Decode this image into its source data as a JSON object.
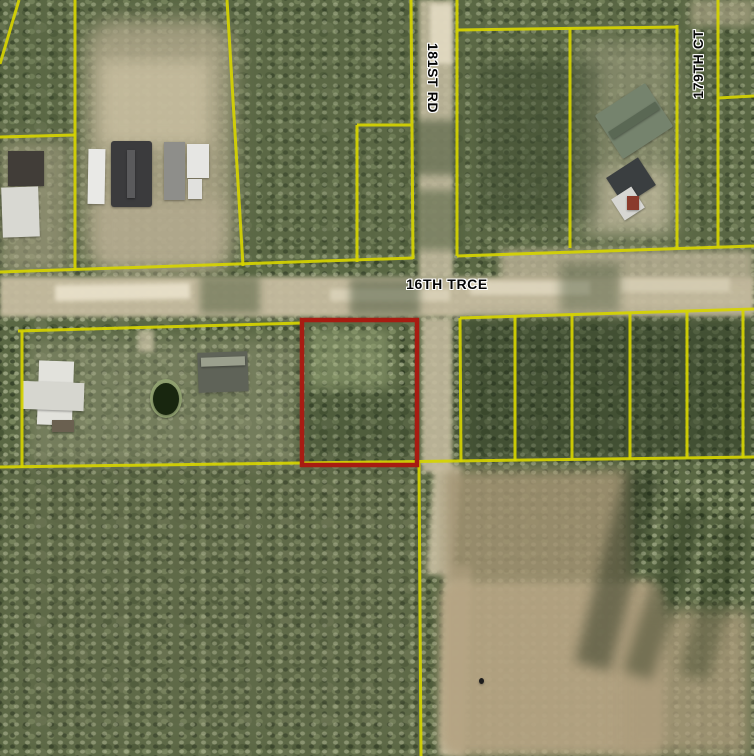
{
  "map": {
    "width": 754,
    "height": 756,
    "description": "Aerial parcel map with subject parcel outlined in red",
    "colors": {
      "parcel_line": "#d6d400",
      "highlight": "#a81c12",
      "forest": "#5a6844",
      "road": "#c6bca0",
      "field": "#b5a483",
      "label_text": "#050505",
      "label_halo": "#ffffff"
    },
    "labels": [
      {
        "name": "street-label-181st-rd",
        "text": "181ST RD",
        "x": 433,
        "y": 78,
        "orientation": "vertical-down"
      },
      {
        "name": "street-label-179th-ct",
        "text": "179TH CT",
        "x": 698,
        "y": 64,
        "orientation": "vertical-up"
      },
      {
        "name": "street-label-16th-trce",
        "text": "16TH TRCE",
        "x": 447,
        "y": 284,
        "orientation": "horizontal"
      }
    ],
    "highlight_parcel": {
      "name": "highlighted-parcel-outline",
      "x": 302,
      "y": 320,
      "w": 115,
      "h": 145,
      "stroke_width": 4.5
    },
    "parcel_lines": [
      {
        "name": "boundary-topleft-diagonal",
        "x1": 19,
        "y1": 0,
        "x2": 0,
        "y2": 64
      },
      {
        "name": "boundary-vertical-75",
        "x1": 75,
        "y1": 0,
        "x2": 75,
        "y2": 270
      },
      {
        "name": "boundary-horizontal-left",
        "x1": 0,
        "y1": 137,
        "x2": 75,
        "y2": 135
      },
      {
        "name": "boundary-vertical-235",
        "x1": 227,
        "y1": 0,
        "x2": 243,
        "y2": 266
      },
      {
        "name": "road-north-boundary-west",
        "x1": 0,
        "y1": 272,
        "x2": 413,
        "y2": 258
      },
      {
        "name": "boundary-vertical-357",
        "x1": 357,
        "y1": 262,
        "x2": 357,
        "y2": 125
      },
      {
        "name": "boundary-horizontal-357-411",
        "x1": 357,
        "y1": 125,
        "x2": 411,
        "y2": 125
      },
      {
        "name": "boundary-vertical-412-west-of-181st",
        "x1": 411,
        "y1": 0,
        "x2": 413,
        "y2": 259
      },
      {
        "name": "boundary-vertical-457-east-of-181st",
        "x1": 457,
        "y1": 0,
        "x2": 457,
        "y2": 256
      },
      {
        "name": "boundary-horizontal-457-677",
        "x1": 457,
        "y1": 30,
        "x2": 677,
        "y2": 27
      },
      {
        "name": "boundary-vertical-570",
        "x1": 570,
        "y1": 28,
        "x2": 570,
        "y2": 248
      },
      {
        "name": "boundary-vertical-677",
        "x1": 677,
        "y1": 25,
        "x2": 677,
        "y2": 249
      },
      {
        "name": "boundary-vertical-718",
        "x1": 718,
        "y1": 0,
        "x2": 718,
        "y2": 248
      },
      {
        "name": "boundary-horizontal-718-754",
        "x1": 718,
        "y1": 98,
        "x2": 754,
        "y2": 96
      },
      {
        "name": "road-north-boundary-east",
        "x1": 457,
        "y1": 256,
        "x2": 754,
        "y2": 246
      },
      {
        "name": "road-south-boundary-west",
        "x1": 18,
        "y1": 331,
        "x2": 302,
        "y2": 323
      },
      {
        "name": "boundary-vertical-22",
        "x1": 22,
        "y1": 331,
        "x2": 22,
        "y2": 468
      },
      {
        "name": "road-south-boundary-east",
        "x1": 460,
        "y1": 318,
        "x2": 754,
        "y2": 309
      },
      {
        "name": "boundary-vertical-460",
        "x1": 460,
        "y1": 318,
        "x2": 461,
        "y2": 462
      },
      {
        "name": "boundary-vertical-515",
        "x1": 515,
        "y1": 316,
        "x2": 515,
        "y2": 461
      },
      {
        "name": "boundary-vertical-572",
        "x1": 572,
        "y1": 314,
        "x2": 572,
        "y2": 460
      },
      {
        "name": "boundary-vertical-630",
        "x1": 630,
        "y1": 313,
        "x2": 630,
        "y2": 459
      },
      {
        "name": "boundary-vertical-687",
        "x1": 687,
        "y1": 312,
        "x2": 687,
        "y2": 458
      },
      {
        "name": "boundary-vertical-743",
        "x1": 743,
        "y1": 310,
        "x2": 743,
        "y2": 458
      },
      {
        "name": "boundary-horizontal-bottom",
        "x1": 0,
        "y1": 467,
        "x2": 754,
        "y2": 457
      },
      {
        "name": "boundary-vertical-south-420",
        "x1": 419,
        "y1": 463,
        "x2": 421,
        "y2": 756
      }
    ],
    "regions": [
      {
        "name": "forest-tint-top",
        "x": 0,
        "y": 0,
        "w": 754,
        "h": 270,
        "color": "#5d6a48",
        "opacity": 0.35,
        "blur": 20
      },
      {
        "name": "forest-tint-bottomleft",
        "x": 0,
        "y": 460,
        "w": 430,
        "h": 296,
        "color": "#6b6f52",
        "opacity": 0.3,
        "blur": 20
      },
      {
        "name": "clearing-top-center",
        "x": 85,
        "y": 20,
        "w": 148,
        "h": 250,
        "color": "#b4aa8e",
        "opacity": 0.8,
        "blur": 10,
        "radius": "30px"
      },
      {
        "name": "clearing-top-center-bright",
        "x": 100,
        "y": 60,
        "w": 110,
        "h": 85,
        "color": "#cfc5a6",
        "opacity": 0.7,
        "blur": 8
      },
      {
        "name": "yard-top-center-low",
        "x": 95,
        "y": 200,
        "w": 130,
        "h": 70,
        "color": "#b9af94",
        "opacity": 0.6,
        "blur": 8
      },
      {
        "name": "clearing-left",
        "x": 0,
        "y": 140,
        "w": 70,
        "h": 135,
        "color": "#afa78c",
        "opacity": 0.55,
        "blur": 8
      },
      {
        "name": "clearing-top-right",
        "x": 580,
        "y": 40,
        "w": 95,
        "h": 200,
        "color": "#a3a285",
        "opacity": 0.55,
        "blur": 10
      },
      {
        "name": "clearing-top-right-bright",
        "x": 590,
        "y": 170,
        "w": 80,
        "h": 60,
        "color": "#c9c0a4",
        "opacity": 0.6,
        "blur": 8
      },
      {
        "name": "path-179th-corner",
        "x": 690,
        "y": 0,
        "w": 64,
        "h": 26,
        "color": "#b8ae90",
        "opacity": 0.6,
        "blur": 4
      },
      {
        "name": "dark-woods-mid-top",
        "x": 480,
        "y": 60,
        "w": 120,
        "h": 160,
        "color": "#36442c",
        "opacity": 0.4,
        "blur": 8
      },
      {
        "name": "road-16th-trce-band",
        "x": 0,
        "y": 277,
        "w": 754,
        "h": 40,
        "color": "#c6bca0",
        "opacity": 0.95,
        "blur": 2
      },
      {
        "name": "road-right-upper",
        "x": 500,
        "y": 250,
        "w": 254,
        "h": 34,
        "color": "#bdb398",
        "opacity": 0.8,
        "blur": 4
      },
      {
        "name": "road-bright-patch-1",
        "x": 55,
        "y": 284,
        "w": 135,
        "h": 16,
        "color": "#eae2cb",
        "opacity": 0.9,
        "blur": 2,
        "rotate": -1
      },
      {
        "name": "road-bright-patch-2",
        "x": 330,
        "y": 289,
        "w": 120,
        "h": 12,
        "color": "#ddd5bc",
        "opacity": 0.8,
        "blur": 2
      },
      {
        "name": "road-bright-patch-3",
        "x": 470,
        "y": 281,
        "w": 120,
        "h": 14,
        "color": "#e2dac2",
        "opacity": 0.8,
        "blur": 2
      },
      {
        "name": "road-bright-patch-4",
        "x": 620,
        "y": 278,
        "w": 110,
        "h": 14,
        "color": "#d8d0b6",
        "opacity": 0.8,
        "blur": 2
      },
      {
        "name": "tree-shadow-over-road-1",
        "x": 200,
        "y": 276,
        "w": 60,
        "h": 38,
        "color": "#4e5c3c",
        "opacity": 0.5,
        "blur": 4
      },
      {
        "name": "tree-shadow-over-road-2",
        "x": 350,
        "y": 278,
        "w": 70,
        "h": 38,
        "color": "#46543a",
        "opacity": 0.5,
        "blur": 4
      },
      {
        "name": "tree-shadow-over-road-3",
        "x": 560,
        "y": 262,
        "w": 60,
        "h": 50,
        "color": "#4e5c40",
        "opacity": 0.45,
        "blur": 5
      },
      {
        "name": "road-181st-corridor",
        "x": 419,
        "y": 0,
        "w": 34,
        "h": 278,
        "color": "#c6bda2",
        "opacity": 0.85,
        "blur": 2
      },
      {
        "name": "road-181st-bright",
        "x": 430,
        "y": 4,
        "w": 22,
        "h": 60,
        "color": "#e8e0c8",
        "opacity": 0.8,
        "blur": 2
      },
      {
        "name": "trees-over-181st-1",
        "x": 412,
        "y": 120,
        "w": 50,
        "h": 55,
        "color": "#4c5a3c",
        "opacity": 0.6,
        "blur": 4
      },
      {
        "name": "trees-over-181st-2",
        "x": 415,
        "y": 190,
        "w": 48,
        "h": 60,
        "color": "#51603f",
        "opacity": 0.55,
        "blur": 4
      },
      {
        "name": "dark-woods-right-mid",
        "x": 462,
        "y": 318,
        "w": 292,
        "h": 142,
        "color": "#2c3a24",
        "opacity": 0.5,
        "blur": 6
      },
      {
        "name": "clearing-southwest",
        "x": 28,
        "y": 338,
        "w": 270,
        "h": 126,
        "color": "#95987a",
        "opacity": 0.45,
        "blur": 8
      },
      {
        "name": "path-southwest",
        "x": 138,
        "y": 330,
        "w": 16,
        "h": 22,
        "color": "#cfc6aa",
        "opacity": 0.7,
        "blur": 2
      },
      {
        "name": "canopy-light-red-parcel",
        "x": 310,
        "y": 330,
        "w": 80,
        "h": 60,
        "color": "#97a578",
        "opacity": 0.5,
        "blur": 5
      },
      {
        "name": "canopy-dark-red-parcel",
        "x": 300,
        "y": 390,
        "w": 120,
        "h": 70,
        "color": "#3c4a30",
        "opacity": 0.35,
        "blur": 8
      },
      {
        "name": "road-south-1",
        "x": 422,
        "y": 318,
        "w": 30,
        "h": 155,
        "color": "#c3ba9e",
        "opacity": 0.9,
        "blur": 2
      },
      {
        "name": "road-south-2",
        "x": 430,
        "y": 465,
        "w": 28,
        "h": 110,
        "color": "#c9bfa2",
        "opacity": 0.9,
        "blur": 3,
        "rotate": 4
      },
      {
        "name": "road-south-3",
        "x": 442,
        "y": 565,
        "w": 26,
        "h": 191,
        "color": "#cbc0a2",
        "opacity": 0.9,
        "blur": 3,
        "rotate": 2
      },
      {
        "name": "field-upper-scrub",
        "x": 445,
        "y": 470,
        "w": 185,
        "h": 115,
        "color": "#a19272",
        "opacity": 0.85,
        "blur": 6
      },
      {
        "name": "field-main",
        "x": 440,
        "y": 580,
        "w": 225,
        "h": 176,
        "color": "#b5a483",
        "opacity": 0.95,
        "blur": 5,
        "radius": "20px"
      },
      {
        "name": "field-right-extension",
        "x": 620,
        "y": 610,
        "w": 130,
        "h": 146,
        "color": "#ac9c7c",
        "opacity": 0.8,
        "blur": 8
      },
      {
        "name": "tree-shadow-streak-1",
        "x": 600,
        "y": 470,
        "w": 36,
        "h": 200,
        "color": "#1f2b18",
        "opacity": 0.45,
        "blur": 6,
        "rotate": 15
      },
      {
        "name": "tree-shadow-streak-2",
        "x": 650,
        "y": 500,
        "w": 30,
        "h": 180,
        "color": "#223018",
        "opacity": 0.4,
        "blur": 6,
        "rotate": 18
      },
      {
        "name": "tree-shadow-streak-3",
        "x": 700,
        "y": 520,
        "w": 30,
        "h": 160,
        "color": "#243218",
        "opacity": 0.35,
        "blur": 6,
        "rotate": 15
      }
    ],
    "buildings": [
      {
        "name": "house-dark-roof-left",
        "x": 8,
        "y": 151,
        "w": 36,
        "h": 35,
        "color": "#413d38"
      },
      {
        "name": "building-white-roof-left",
        "x": 2,
        "y": 187,
        "w": 37,
        "h": 50,
        "color": "#d8d8d2",
        "rotate": -2
      },
      {
        "name": "rv-white-1",
        "x": 88,
        "y": 149,
        "w": 17,
        "h": 55,
        "color": "#e9e9e6",
        "rotate": 1
      },
      {
        "name": "house-main-dark-roof",
        "x": 111,
        "y": 141,
        "w": 41,
        "h": 66,
        "color": "#3b3b3d",
        "radius": "3px"
      },
      {
        "name": "house-main-ridge",
        "x": 127,
        "y": 150,
        "w": 8,
        "h": 48,
        "color": "#5a5a5c"
      },
      {
        "name": "trailer-gray",
        "x": 164,
        "y": 142,
        "w": 21,
        "h": 58,
        "color": "#8e8e8a"
      },
      {
        "name": "rv-white-2",
        "x": 187,
        "y": 144,
        "w": 22,
        "h": 34,
        "color": "#e6e6e3"
      },
      {
        "name": "rv-white-3",
        "x": 188,
        "y": 179,
        "w": 14,
        "h": 20,
        "color": "#e1e1de"
      },
      {
        "name": "house-green-metal-roof",
        "x": 604,
        "y": 95,
        "w": 60,
        "h": 52,
        "color": "#75836d",
        "rotate": -33,
        "radius": "2px"
      },
      {
        "name": "house-green-roof-ridge",
        "x": 606,
        "y": 116,
        "w": 56,
        "h": 9,
        "color": "#5a6854",
        "rotate": -33
      },
      {
        "name": "shed-dark-top-right",
        "x": 612,
        "y": 165,
        "w": 38,
        "h": 33,
        "color": "#3a3e40",
        "rotate": -33
      },
      {
        "name": "trailer-white-top-right",
        "x": 616,
        "y": 191,
        "w": 24,
        "h": 25,
        "color": "#d6d6d2",
        "rotate": -33
      },
      {
        "name": "object-red-top-right",
        "x": 627,
        "y": 196,
        "w": 12,
        "h": 14,
        "color": "#8a3a2c"
      },
      {
        "name": "house-white-sw-main",
        "x": 38,
        "y": 361,
        "w": 35,
        "h": 64,
        "color": "#e2e2dc",
        "rotate": 2
      },
      {
        "name": "house-white-sw-wing",
        "x": 22,
        "y": 382,
        "w": 62,
        "h": 28,
        "color": "#d6d6cf",
        "rotate": 2
      },
      {
        "name": "deck-sw",
        "x": 52,
        "y": 420,
        "w": 22,
        "h": 12,
        "color": "#6a6050"
      },
      {
        "name": "pond-rim",
        "x": 150,
        "y": 379,
        "w": 32,
        "h": 39,
        "color": "#8fa06f",
        "radius": "50%"
      },
      {
        "name": "pond",
        "x": 153,
        "y": 383,
        "w": 26,
        "h": 32,
        "color": "#18260f",
        "radius": "50%"
      },
      {
        "name": "trailer-sw-dark",
        "x": 198,
        "y": 352,
        "w": 50,
        "h": 40,
        "color": "#5f6358",
        "rotate": -2
      },
      {
        "name": "trailer-sw-sheen",
        "x": 201,
        "y": 357,
        "w": 44,
        "h": 9,
        "color": "#9ba08e",
        "rotate": -2
      },
      {
        "name": "figure-dot-field",
        "x": 479,
        "y": 678,
        "w": 5,
        "h": 6,
        "color": "#1c1c1c",
        "radius": "50%"
      }
    ]
  }
}
